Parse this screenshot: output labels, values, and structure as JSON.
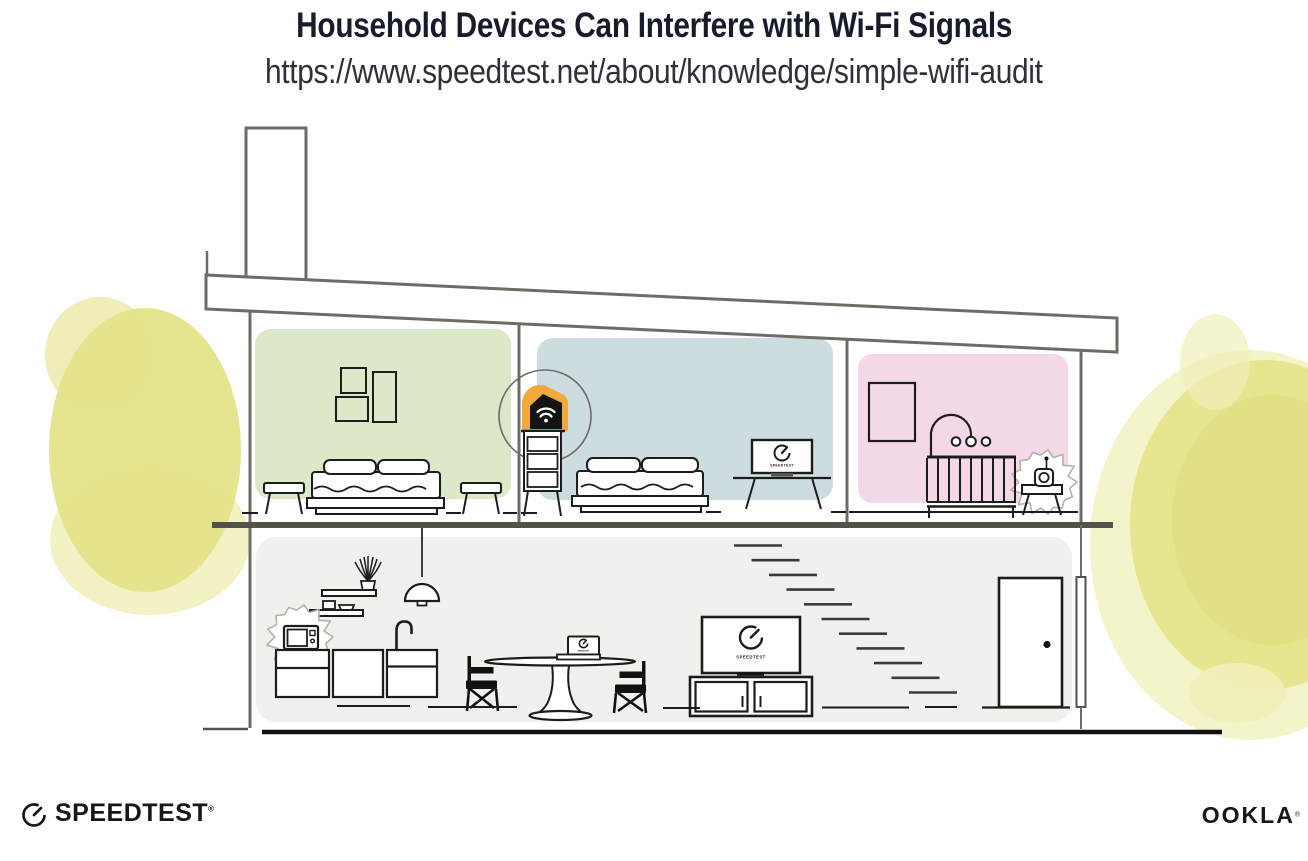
{
  "header": {
    "title": "Household Devices Can Interfere with Wi-Fi Signals",
    "url": "https://www.speedtest.net/about/knowledge/simple-wifi-audit"
  },
  "illustration": {
    "screen_label": "SPEEDTEST"
  },
  "branding": {
    "speedtest_logo": "SPEEDTEST",
    "speedtest_trademark": "®",
    "ookla_logo": "OOKLA",
    "ookla_trademark": "®"
  },
  "colors": {
    "title_text": "#181b2c",
    "url_text": "#30303a",
    "line_gray": "#6d6c66",
    "floor_line": "#53524d",
    "ground_line": "#111111",
    "furniture_ink": "#1c1c1c",
    "room_green": "#dde8c9",
    "room_blue": "#cddcde",
    "room_pink": "#f5d8e8",
    "room_gray": "#f1f0ed",
    "router_orange": "#f2a93b",
    "router_black": "#131313",
    "foliage_yellow": "#e4e38a",
    "foliage_dark": "#dcdc7c",
    "foliage_light": "#f0f0ba",
    "burst_gray": "#b3b1aa",
    "logo_ink": "#171717"
  }
}
